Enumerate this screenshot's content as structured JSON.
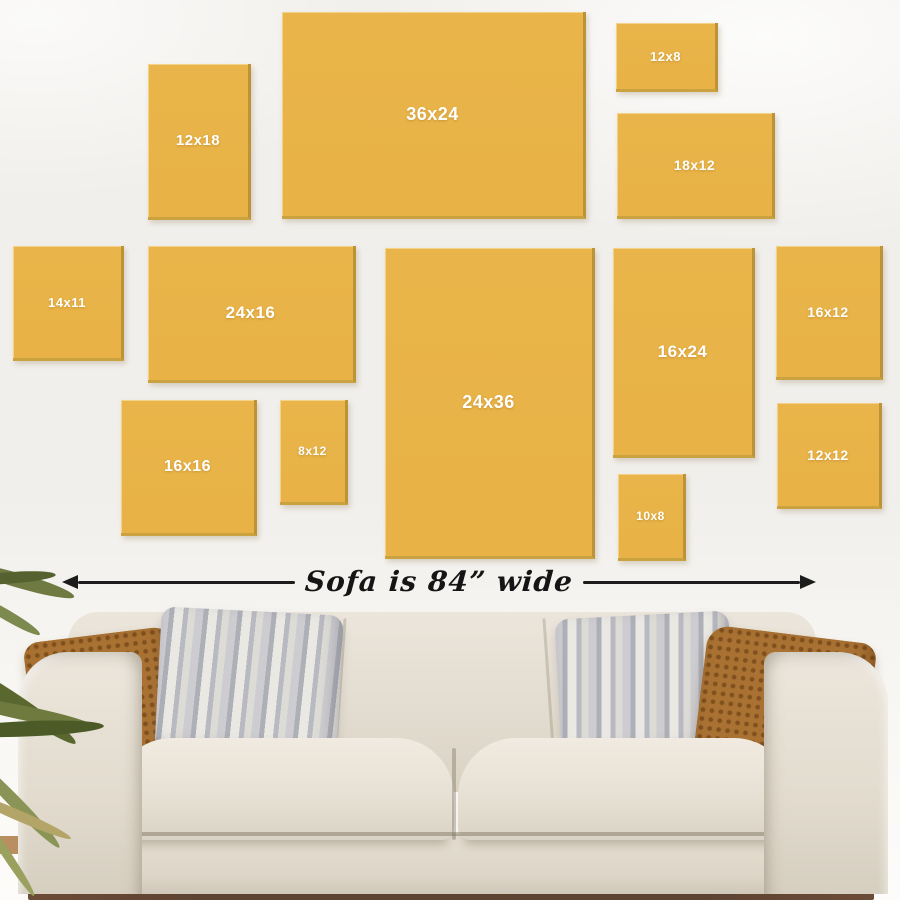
{
  "frames": [
    {
      "label": "12x18"
    },
    {
      "label": "36x24"
    },
    {
      "label": "12x8"
    },
    {
      "label": "18x12"
    },
    {
      "label": "14x11"
    },
    {
      "label": "24x16"
    },
    {
      "label": "24x36"
    },
    {
      "label": "16x24"
    },
    {
      "label": "16x12"
    },
    {
      "label": "16x16"
    },
    {
      "label": "8x12"
    },
    {
      "label": "10x8"
    },
    {
      "label": "12x12"
    }
  ],
  "measurement": {
    "label": "Sofa is 84” wide"
  },
  "colors": {
    "frame_yellow": "#e9b449",
    "frame_edge": "#bd9338",
    "label_white": "#ffffff",
    "wall": "#f1efeb",
    "arrow_black": "#1c1c1c",
    "sofa_cream": "#e6e0d5",
    "pillow_rust": "#a97233",
    "pillow_gray": "#c3c3c9",
    "plant_green": "#5a682f",
    "floor_brown": "#5d4332"
  }
}
